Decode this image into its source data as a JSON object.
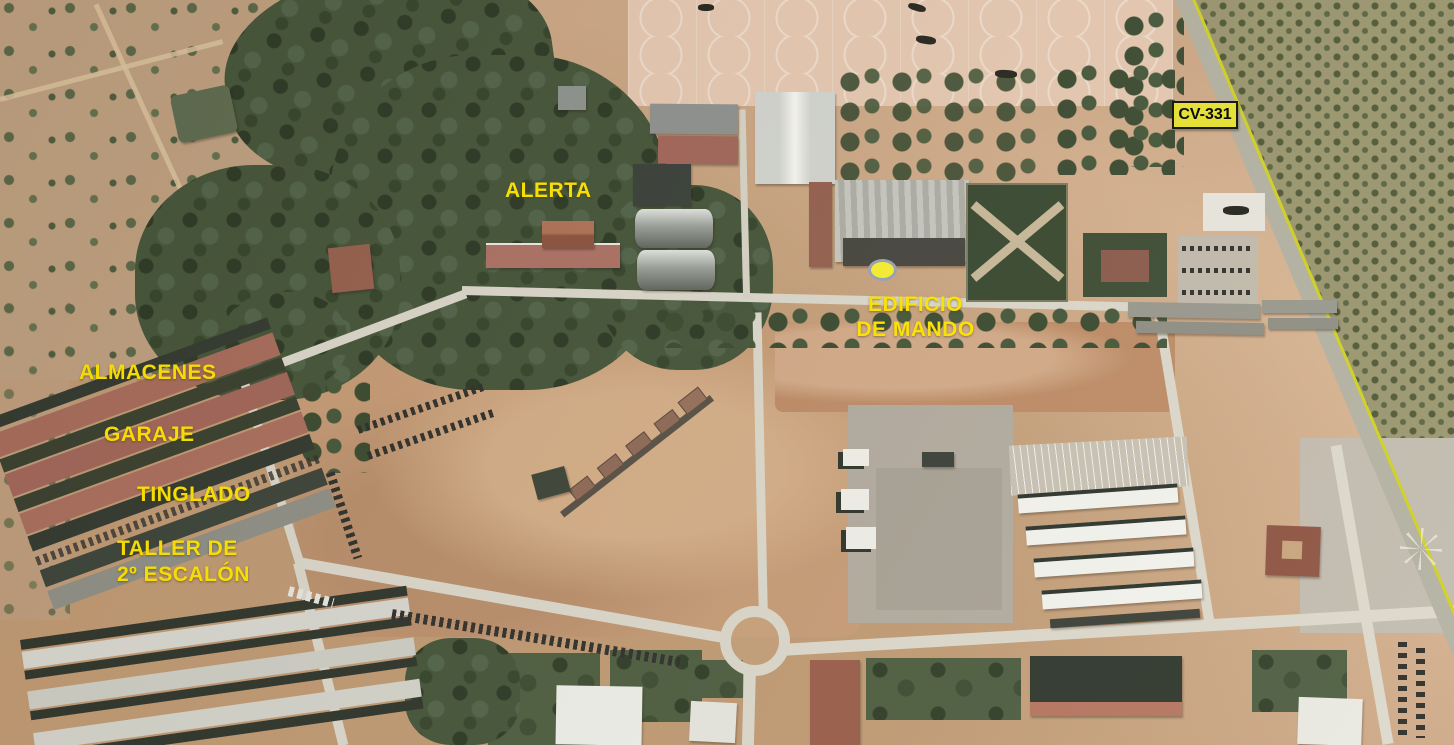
{
  "map": {
    "kind": "annotated-satellite-photo",
    "subject": "military base aerial view with helicopter apron, hangars, warehouses and road network"
  },
  "annotations": {
    "alerta": {
      "label": "ALERTA"
    },
    "edificio_de_mando": {
      "line1": "EDIFICIO",
      "line2": "DE MANDO"
    },
    "almacenes": {
      "label": "ALMACENES"
    },
    "garaje": {
      "label": "GARAJE"
    },
    "tinglado": {
      "label": "TINGLADO"
    },
    "taller": {
      "line1": "TALLER DE",
      "line2": "2º ESCALÓN"
    },
    "road_sign": {
      "label": "CV-331"
    }
  },
  "colors": {
    "annotation_text": "#ffe600",
    "road_sign_bg": "#e8e431",
    "road_sign_text": "#000000",
    "marker_fill": "#f8f032",
    "marker_border": "#9aa3b5"
  }
}
